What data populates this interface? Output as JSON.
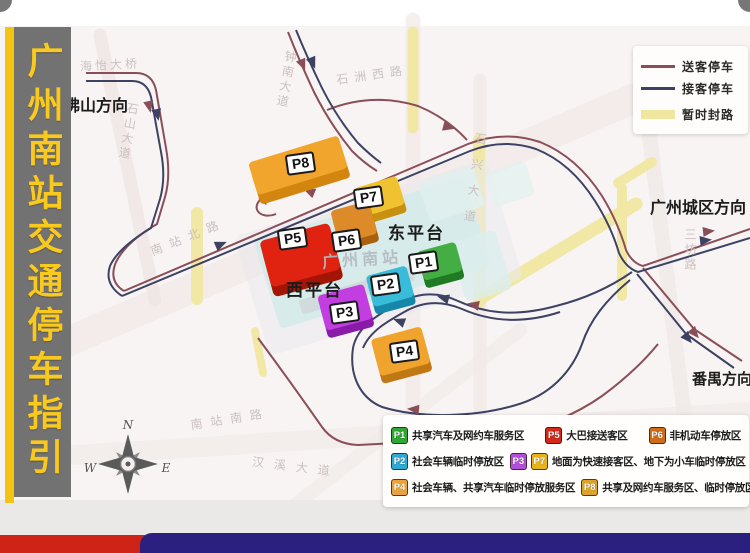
{
  "sidebar": {
    "title": "广州南站交通停车指引"
  },
  "legend_lines": {
    "items": [
      {
        "label": "送客停车",
        "color": "#8a4e58",
        "type": "line"
      },
      {
        "label": "接客停车",
        "color": "#3d4263",
        "type": "line"
      },
      {
        "label": "暂时封路",
        "color": "#efe6a0",
        "type": "band"
      }
    ]
  },
  "legend_parking": {
    "items": [
      {
        "markers": [
          {
            "id": "P1",
            "color": "#2fa636"
          }
        ],
        "text": "共享汽车及网约车服务区"
      },
      {
        "markers": [
          {
            "id": "P5",
            "color": "#d2291c"
          }
        ],
        "text": "大巴接送客区"
      },
      {
        "markers": [
          {
            "id": "P6",
            "color": "#cf6c1a"
          }
        ],
        "text": "非机动车停放区"
      },
      {
        "markers": [
          {
            "id": "P2",
            "color": "#2fa8d2"
          }
        ],
        "text": "社会车辆临时停放区"
      },
      {
        "markers": [
          {
            "id": "P3",
            "color": "#b14fd8"
          },
          {
            "id": "P7",
            "color": "#e6b31e"
          }
        ],
        "text": "地面为快速接客区、地下为小车临时停放区"
      },
      {
        "markers": [
          {
            "id": "P4",
            "color": "#eaa33c"
          }
        ],
        "text": "社会车辆、共享汽车临时停放服务区"
      },
      {
        "markers": [
          {
            "id": "P8",
            "color": "#dda32a"
          }
        ],
        "text": "共享及网约车服务区、临时停放区"
      }
    ]
  },
  "map": {
    "directions": {
      "foshan": "佛山方向",
      "guangzhou_city": "广州城区方向",
      "panyu": "番禺方向"
    },
    "station": {
      "name": "广州南站",
      "east_platform": "东平台",
      "west_platform": "西平台"
    },
    "parking": [
      {
        "id": "P1",
        "color": "#44ad44"
      },
      {
        "id": "P2",
        "color": "#38bcd9"
      },
      {
        "id": "P3",
        "color": "#c33ee0"
      },
      {
        "id": "P4",
        "color": "#f0a42e"
      },
      {
        "id": "P5",
        "color": "#e02310"
      },
      {
        "id": "P6",
        "color": "#dd8a28"
      },
      {
        "id": "P7",
        "color": "#f0c232"
      },
      {
        "id": "P8",
        "color": "#f2a52c"
      }
    ],
    "streets": [
      "海怡大桥",
      "石山大道",
      "钟南大道",
      "石洲西路",
      "南站北路",
      "三坊路",
      "石兴大道",
      "南站南路",
      "汉溪大道"
    ],
    "compass": {
      "n": "N",
      "e": "E",
      "s": "S",
      "w": "W"
    }
  }
}
